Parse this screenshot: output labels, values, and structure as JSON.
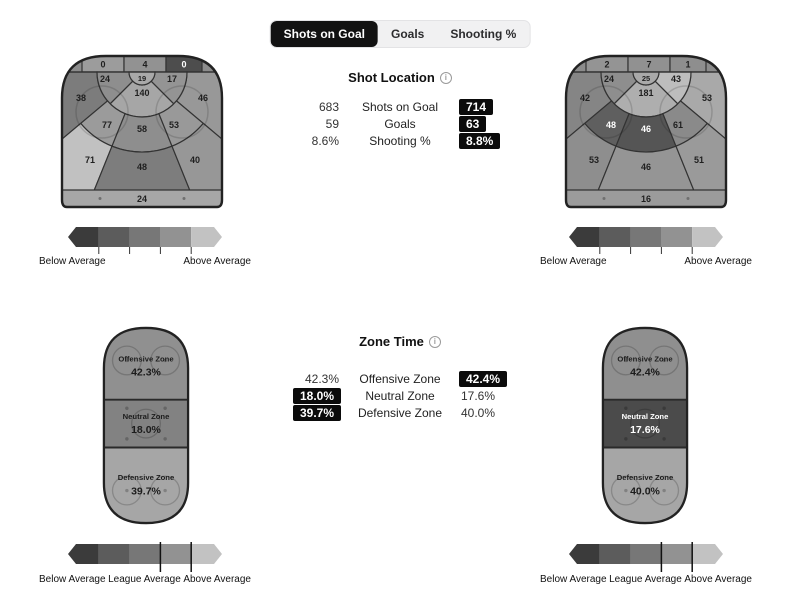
{
  "tabs": {
    "items": [
      {
        "label": "Shots on Goal",
        "active": true
      },
      {
        "label": "Goals",
        "active": false
      },
      {
        "label": "Shooting %",
        "active": false
      }
    ]
  },
  "shot_location": {
    "heading": "Shot Location",
    "info_icon": "i",
    "rows": [
      {
        "away": "683",
        "label": "Shots on Goal",
        "home": "714",
        "highlight": "home"
      },
      {
        "away": "59",
        "label": "Goals",
        "home": "63",
        "highlight": "home"
      },
      {
        "away": "8.6%",
        "label": "Shooting %",
        "home": "8.8%",
        "highlight": "home"
      }
    ]
  },
  "zone_time": {
    "heading": "Zone Time",
    "info_icon": "i",
    "rows": [
      {
        "away": "42.3%",
        "label": "Offensive Zone",
        "home": "42.4%",
        "highlight": "home"
      },
      {
        "away": "18.0%",
        "label": "Neutral Zone",
        "home": "17.6%",
        "highlight": "away"
      },
      {
        "away": "39.7%",
        "label": "Defensive Zone",
        "home": "40.0%",
        "highlight": "away"
      }
    ]
  },
  "shot_chart_away": {
    "base": "#8c8c8c",
    "zones": {
      "behind_left": {
        "value": "0",
        "fill": "#9c9c9c",
        "text": "#1f1f1f"
      },
      "behind_center": {
        "value": "4",
        "fill": "#929292",
        "text": "#1f1f1f"
      },
      "behind_right": {
        "value": "0",
        "fill": "#4d4d4d",
        "text": "#ffffff"
      },
      "crease": {
        "value": "19",
        "fill": "#a9a9a9",
        "text": "#1f1f1f"
      },
      "inner_left": {
        "value": "24",
        "fill": "#8e8e8e",
        "text": "#1f1f1f"
      },
      "slot": {
        "value": "140",
        "fill": "#a6a6a6",
        "text": "#1f1f1f"
      },
      "inner_right": {
        "value": "17",
        "fill": "#949494",
        "text": "#1f1f1f"
      },
      "boards_left": {
        "value": "38",
        "fill": "#7c7c7c",
        "text": "#1f1f1f"
      },
      "boards_right": {
        "value": "46",
        "fill": "#989898",
        "text": "#1f1f1f"
      },
      "mid_left": {
        "value": "77",
        "fill": "#9b9b9b",
        "text": "#1f1f1f"
      },
      "mid_center": {
        "value": "58",
        "fill": "#8e8e8e",
        "text": "#1f1f1f"
      },
      "mid_right": {
        "value": "53",
        "fill": "#999999",
        "text": "#1f1f1f"
      },
      "outer_left": {
        "value": "71",
        "fill": "#c1c1c1",
        "text": "#1f1f1f"
      },
      "outer_center": {
        "value": "48",
        "fill": "#7d7d7d",
        "text": "#1f1f1f"
      },
      "outer_right": {
        "value": "40",
        "fill": "#979797",
        "text": "#1f1f1f"
      },
      "point": {
        "value": "24",
        "fill": "#a7a7a7",
        "text": "#1f1f1f"
      }
    }
  },
  "shot_chart_home": {
    "base": "#8c8c8c",
    "zones": {
      "behind_left": {
        "value": "2",
        "fill": "#949494",
        "text": "#1f1f1f"
      },
      "behind_center": {
        "value": "7",
        "fill": "#919191",
        "text": "#1f1f1f"
      },
      "behind_right": {
        "value": "1",
        "fill": "#8e8e8e",
        "text": "#1f1f1f"
      },
      "crease": {
        "value": "25",
        "fill": "#a9a9a9",
        "text": "#1f1f1f"
      },
      "inner_left": {
        "value": "24",
        "fill": "#8e8e8e",
        "text": "#1f1f1f"
      },
      "slot": {
        "value": "181",
        "fill": "#aeaeae",
        "text": "#1f1f1f"
      },
      "inner_right": {
        "value": "43",
        "fill": "#bdbdbd",
        "text": "#1f1f1f"
      },
      "boards_left": {
        "value": "42",
        "fill": "#858585",
        "text": "#1f1f1f"
      },
      "boards_right": {
        "value": "53",
        "fill": "#a9a9a9",
        "text": "#1f1f1f"
      },
      "mid_left": {
        "value": "48",
        "fill": "#5f5f5f",
        "text": "#ffffff"
      },
      "mid_center": {
        "value": "46",
        "fill": "#555555",
        "text": "#ffffff"
      },
      "mid_right": {
        "value": "61",
        "fill": "#8a8a8a",
        "text": "#1f1f1f"
      },
      "outer_left": {
        "value": "53",
        "fill": "#8e8e8e",
        "text": "#1f1f1f"
      },
      "outer_center": {
        "value": "46",
        "fill": "#959595",
        "text": "#1f1f1f"
      },
      "outer_right": {
        "value": "51",
        "fill": "#9a9a9a",
        "text": "#1f1f1f"
      },
      "point": {
        "value": "16",
        "fill": "#9b9b9b",
        "text": "#1f1f1f"
      }
    }
  },
  "zone_rink_away": {
    "offensive": {
      "name": "Offensive Zone",
      "value": "42.3%",
      "fill": "#909090",
      "text": "#1c1c1c"
    },
    "neutral": {
      "name": "Neutral Zone",
      "value": "18.0%",
      "fill": "#828282",
      "text": "#1c1c1c"
    },
    "defensive": {
      "name": "Defensive Zone",
      "value": "39.7%",
      "fill": "#a6a6a6",
      "text": "#1c1c1c"
    }
  },
  "zone_rink_home": {
    "offensive": {
      "name": "Offensive Zone",
      "value": "42.4%",
      "fill": "#8f8f8f",
      "text": "#1c1c1c"
    },
    "neutral": {
      "name": "Neutral Zone",
      "value": "17.6%",
      "fill": "#4b4b4b",
      "text": "#ffffff"
    },
    "defensive": {
      "name": "Defensive Zone",
      "value": "40.0%",
      "fill": "#a6a6a6",
      "text": "#1c1c1c"
    }
  },
  "legend": {
    "colors": [
      "#3b3b3b",
      "#5c5c5c",
      "#777777",
      "#929292",
      "#c2c2c2"
    ],
    "below_label": "Below Average",
    "league_label": "League Average",
    "above_label": "Above Average"
  },
  "chart_data": [
    {
      "type": "heatmap",
      "title": "Shot Location",
      "categories": [
        "behind_left",
        "behind_center",
        "behind_right",
        "crease",
        "inner_left",
        "slot",
        "inner_right",
        "boards_left",
        "boards_right",
        "mid_left",
        "mid_center",
        "mid_right",
        "outer_left",
        "outer_center",
        "outer_right",
        "point"
      ],
      "series": [
        {
          "name": "away",
          "values": [
            0,
            4,
            0,
            19,
            24,
            140,
            17,
            38,
            46,
            77,
            58,
            53,
            71,
            48,
            40,
            24
          ]
        },
        {
          "name": "home",
          "values": [
            2,
            7,
            1,
            25,
            24,
            181,
            43,
            42,
            53,
            48,
            46,
            61,
            53,
            46,
            51,
            16
          ]
        }
      ],
      "totals": {
        "away": {
          "shots_on_goal": 683,
          "goals": 59,
          "shooting_pct": "8.6%"
        },
        "home": {
          "shots_on_goal": 714,
          "goals": 63,
          "shooting_pct": "8.8%"
        }
      },
      "legend": [
        "Below Average",
        "Above Average"
      ]
    },
    {
      "type": "heatmap",
      "title": "Zone Time",
      "categories": [
        "Offensive Zone",
        "Neutral Zone",
        "Defensive Zone"
      ],
      "series": [
        {
          "name": "away",
          "values": [
            42.3,
            18.0,
            39.7
          ]
        },
        {
          "name": "home",
          "values": [
            42.4,
            17.6,
            40.0
          ]
        }
      ],
      "legend": [
        "Below Average",
        "League Average",
        "Above Average"
      ]
    }
  ]
}
